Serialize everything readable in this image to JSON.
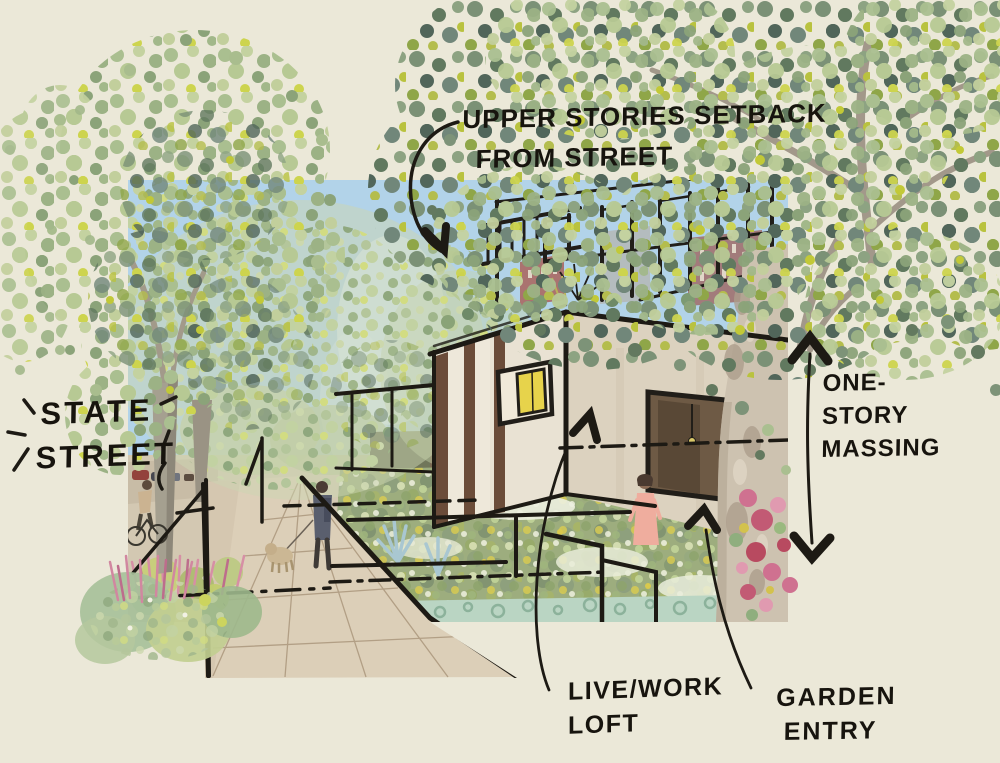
{
  "annotations": {
    "upper_stories": {
      "line1": "UPPER STORIES SETBACK",
      "line2": "FROM STREET"
    },
    "state_street": {
      "line1": "STATE",
      "line2": "STREET"
    },
    "one_story_massing": {
      "line1": "ONE-",
      "line2": "STORY",
      "line3": "MASSING"
    },
    "live_work_loft": {
      "line1": "LIVE/WORK",
      "line2": "LOFT"
    },
    "garden_entry": {
      "line1": "GARDEN",
      "line2": "ENTRY"
    }
  },
  "colors": {
    "background": "#ebe8d8",
    "ink": "#1d1a14",
    "sky": "#b2d3e9",
    "canopy_light": "#b7c897",
    "canopy_dark": "#69806c",
    "leaf_yellow": "#c2c937",
    "trunk": "#a89c8c",
    "wall_light": "#e9e2d3",
    "wall_shade": "#dcd2bf",
    "sidewalk": "#dccfb8",
    "window_glow": "#e7d34b",
    "flower_pink": "#cf7190",
    "succulent": "#bad5c3",
    "person_pink": "#efad9e"
  }
}
